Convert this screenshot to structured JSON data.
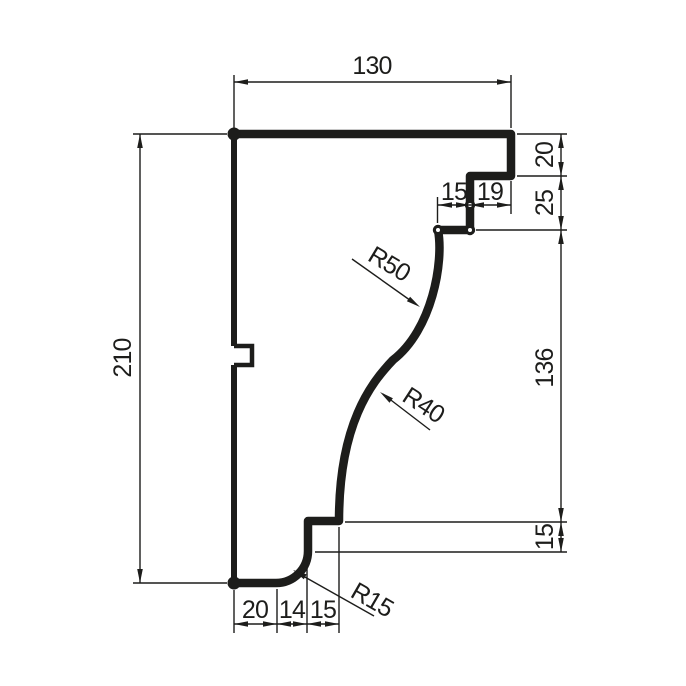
{
  "drawing": {
    "kind": "cornice-moulding-profile-section",
    "colors": {
      "line": "#1d1d1b",
      "background": "#ffffff"
    },
    "dims": {
      "top_width": "130",
      "left_height": "210",
      "right_stack": {
        "top": "20",
        "step": "25",
        "curve": "136",
        "lower": "15"
      },
      "inner_step": {
        "left": "15",
        "right": "19"
      },
      "bottom_row": {
        "left": "20",
        "middle": "14",
        "right": "15"
      },
      "radii": {
        "upper": "R50",
        "lower": "R40",
        "bottom": "R15"
      }
    }
  }
}
